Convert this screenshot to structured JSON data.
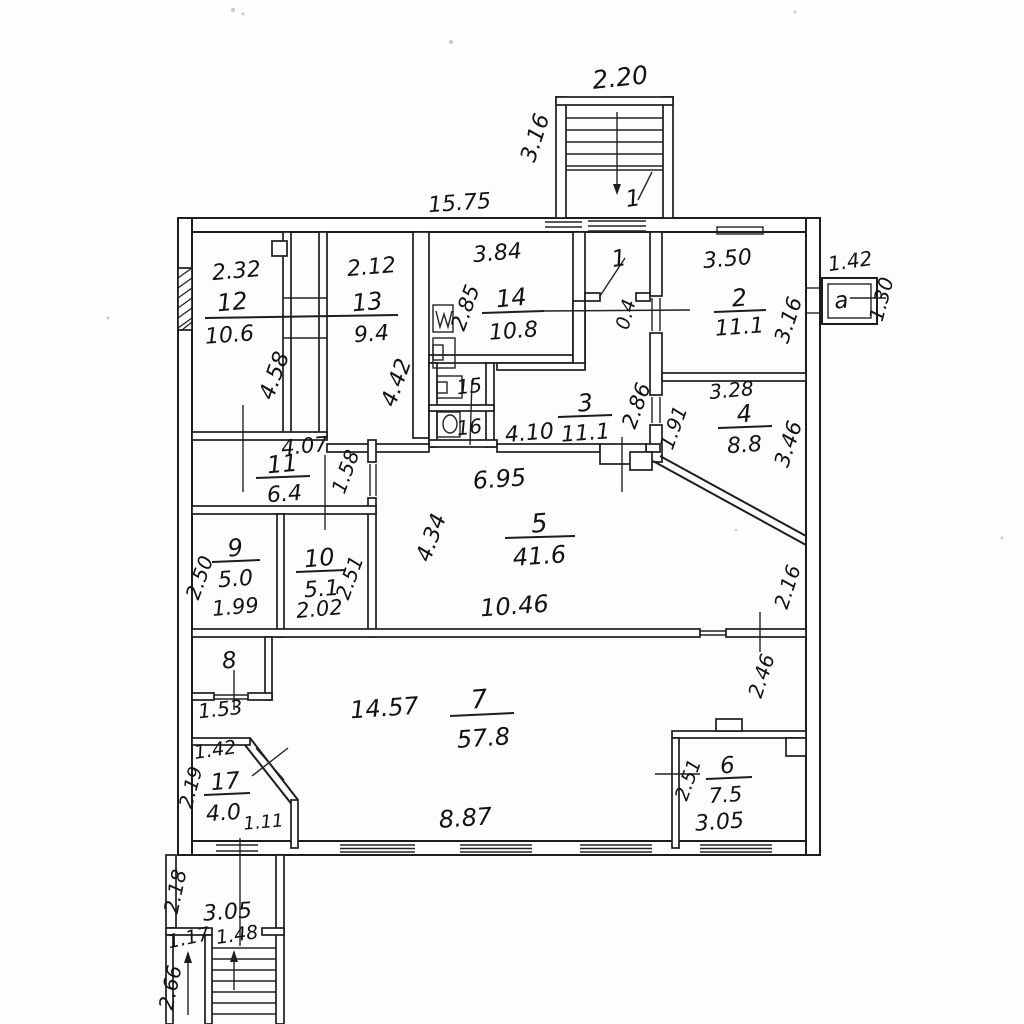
{
  "plan": {
    "rooms": {
      "r1_landing": {
        "number": "1"
      },
      "r1_vestibule": {
        "number": "1"
      },
      "r2": {
        "number": "2",
        "area": "11.1"
      },
      "r3": {
        "number": "3",
        "area": "11.1"
      },
      "r4": {
        "number": "4",
        "area": "8.8"
      },
      "r5": {
        "number": "5",
        "area": "41.6"
      },
      "r6": {
        "number": "6",
        "area": "7.5"
      },
      "r7": {
        "number": "7",
        "area": "57.8"
      },
      "r8": {
        "number": "8"
      },
      "r9": {
        "number": "9",
        "area": "5.0"
      },
      "r10": {
        "number": "10",
        "area": "5.1"
      },
      "r11": {
        "number": "11",
        "area": "6.4"
      },
      "r12": {
        "number": "12",
        "area": "10.6"
      },
      "r13": {
        "number": "13",
        "area": "9.4"
      },
      "r14": {
        "number": "14",
        "area": "10.8"
      },
      "r15": {
        "number": "15"
      },
      "r16": {
        "number": "16"
      },
      "r17": {
        "number": "17",
        "area": "4.0"
      },
      "annex": {
        "letter": "a"
      }
    },
    "dims": {
      "stair_width": "2.20",
      "stair_length": "3.16",
      "top_wall": "15.75",
      "annex_width": "1.42",
      "annex_depth": "1.30",
      "r12_w": "2.32",
      "r12_h": "4.58",
      "r13_w": "2.12",
      "r13_h": "4.42",
      "r14_w": "3.84",
      "r14_h": "2.85",
      "vestibule_w": "0.4",
      "r2_w": "3.50",
      "r2_h": "3.16",
      "r4_w": "3.28",
      "r4_h_left": "1.91",
      "r4_h_right": "3.46",
      "r3_w": "4.10",
      "r3_h": "2.86",
      "r11_w": "4.07",
      "r11_h": "1.58",
      "r9_w": "1.99",
      "r9_h": "2.50",
      "r10_w": "2.02",
      "r10_h": "2.51",
      "r5_w_top": "6.95",
      "r5_h": "4.34",
      "r5_w_bottom": "10.46",
      "right_wall_upper": "2.16",
      "right_wall_lower": "2.46",
      "r8_w": "1.53",
      "r17_w_top": "1.42",
      "r17_h": "2.19",
      "r17_w_bottom": "1.11",
      "r7_w": "14.57",
      "r7_w_bottom": "8.87",
      "r6_h": "2.51",
      "r6_w": "3.05",
      "porch_h": "2.18",
      "porch_w": "3.05",
      "entry_side_w": "1.17",
      "entry_stairs_w": "1.48",
      "entry_stairs_l": "2.66"
    }
  }
}
